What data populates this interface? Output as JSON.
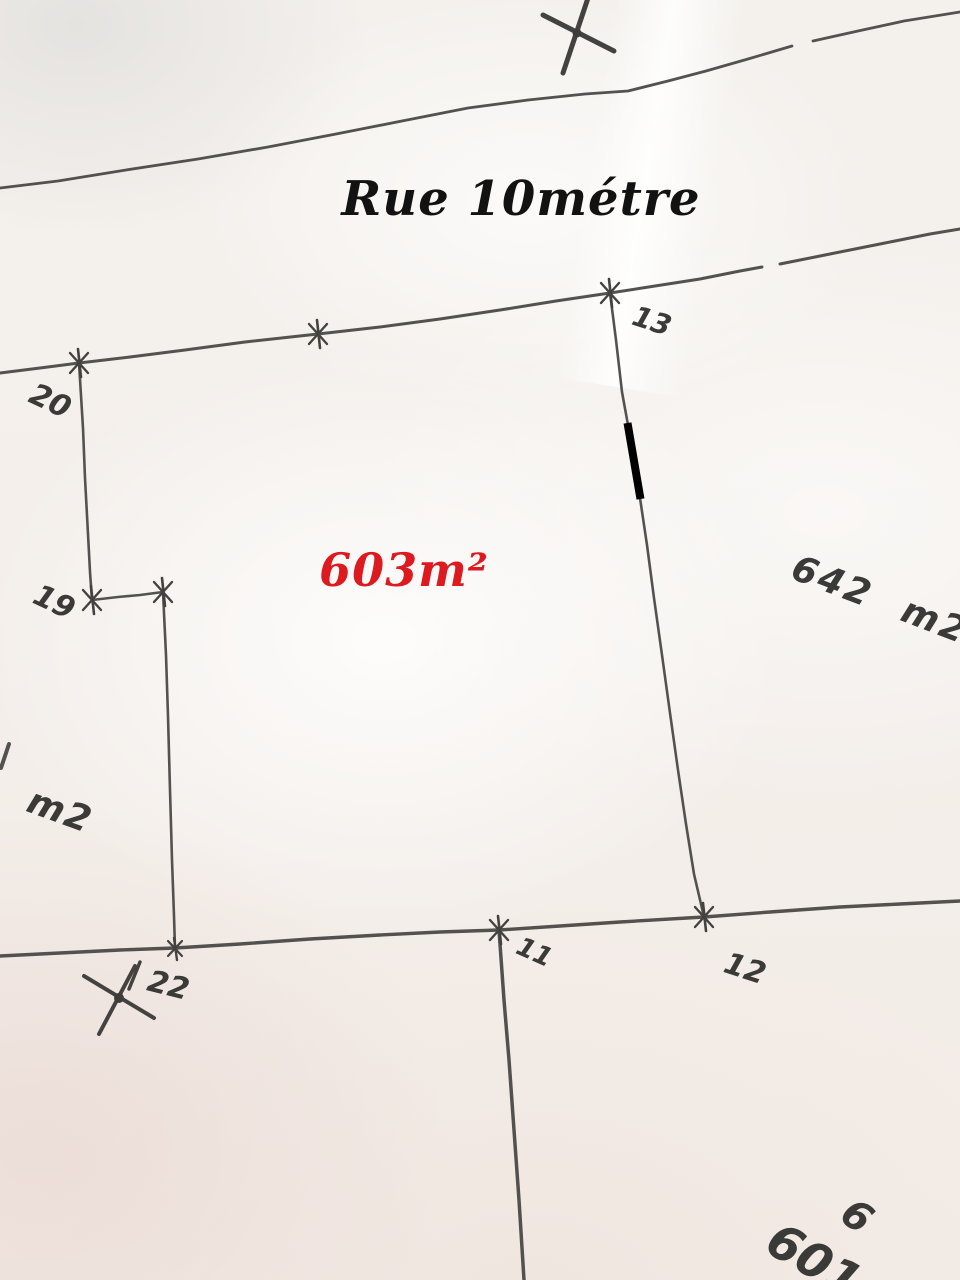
{
  "street": {
    "name": "Rue 10métre"
  },
  "parcels": {
    "main": {
      "area_label": "603m²"
    },
    "right": {
      "area_label": "642 m2"
    },
    "left": {
      "area_label": "m2"
    },
    "bottom_right": {
      "block_number": "6",
      "parcel_number": "601"
    }
  },
  "survey_points": {
    "p20": "20",
    "p19": "19",
    "p13": "13",
    "p11": "11",
    "p12": "12",
    "p22": "22"
  },
  "colors": {
    "paper": "#f3efeb",
    "ink": "#4a4947",
    "street_text": "#121212",
    "main_area_text": "#dc1a1f",
    "highlight_mark": "#000000"
  }
}
